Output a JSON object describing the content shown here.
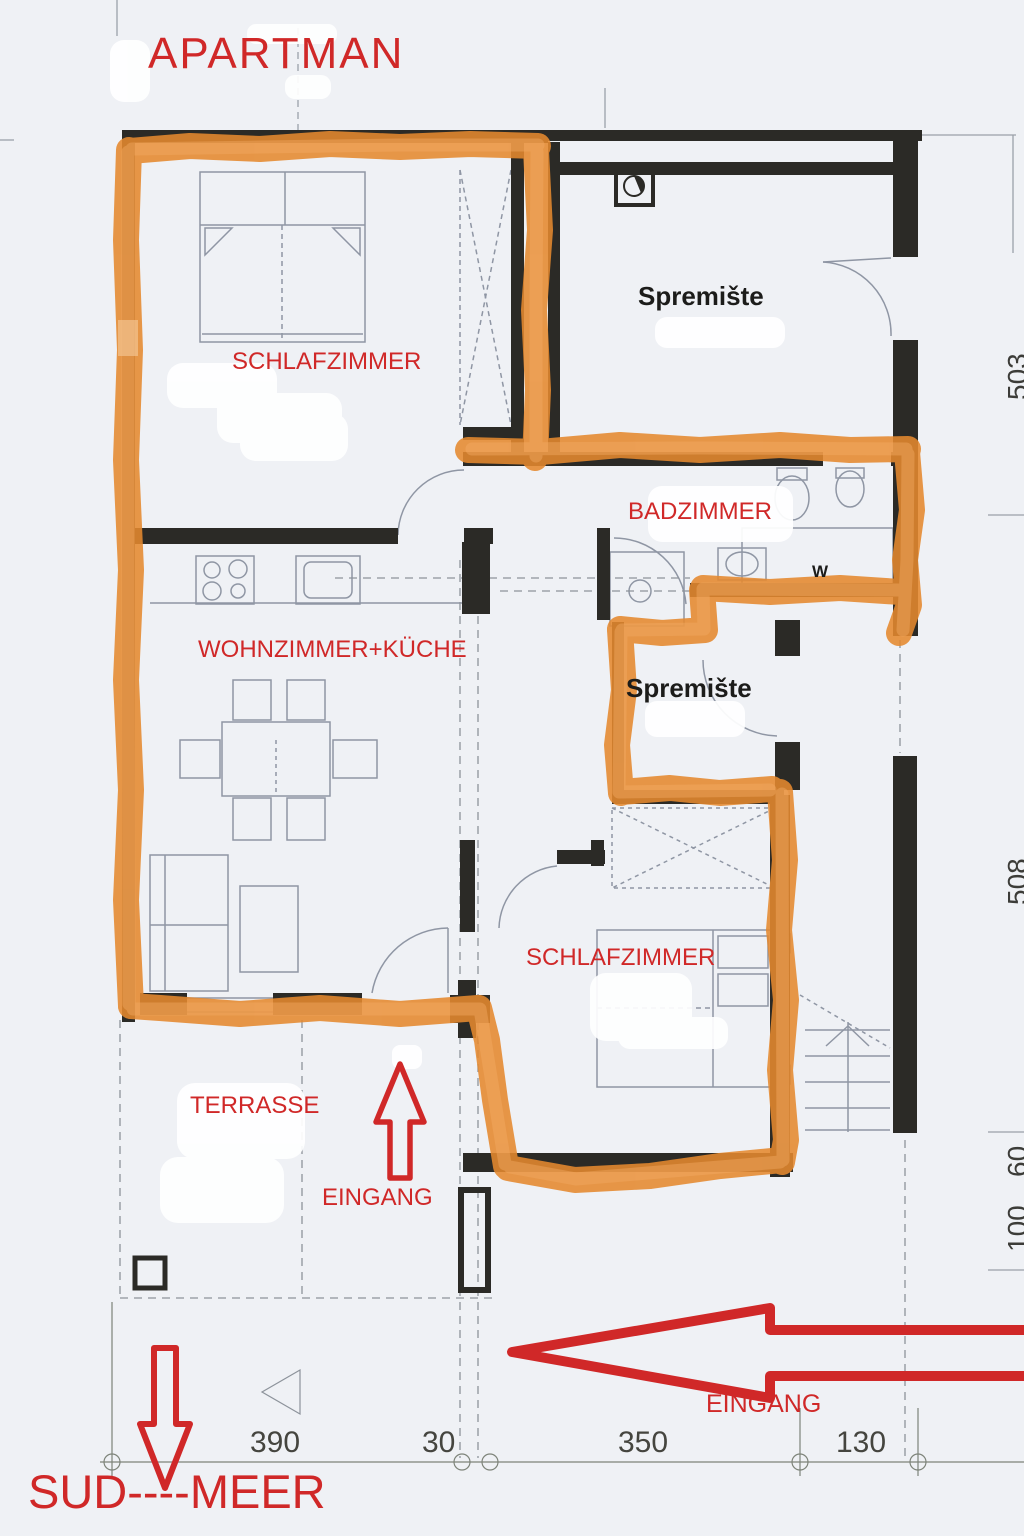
{
  "title": "APARTMAN",
  "rooms": {
    "bedroom1": "SCHLAFZIMMER",
    "storage1": "Spremište",
    "bathroom": "BADZIMMER",
    "living": "WOHNZIMMER+KÜCHE",
    "storage2": "Spremište",
    "bedroom2": "SCHLAFZIMMER",
    "terrace": "TERRASSE",
    "washer": "W"
  },
  "annotations": {
    "entrance_terrace": "EINGANG",
    "entrance_side": "EINGANG",
    "direction": "SUD----MEER"
  },
  "dimensions": {
    "bottom": [
      "390",
      "30",
      "350",
      "130"
    ],
    "right": [
      "503",
      "508",
      "60",
      "100"
    ]
  },
  "colors": {
    "highlight_orange": "#e5892f",
    "annotation_red": "#d02828",
    "wall_black": "#2b2a26"
  }
}
